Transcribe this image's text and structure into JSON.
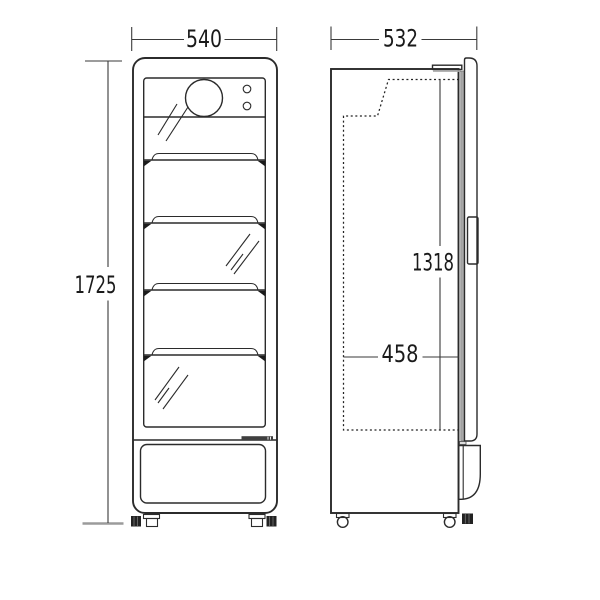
{
  "dimensions": {
    "front_width": "540",
    "front_height": "1725",
    "side_depth": "532",
    "interior_height": "1318",
    "interior_depth": "458"
  },
  "front_view": {
    "shelf_count": 4,
    "indicator_light_count": 2
  },
  "colors": {
    "line": "#2b2b2b",
    "gasket_gray": "#a8a8a8",
    "dim_tick_gray": "#9b9b9b",
    "dark_trim": "#3f3f3f",
    "background": "#ffffff"
  }
}
